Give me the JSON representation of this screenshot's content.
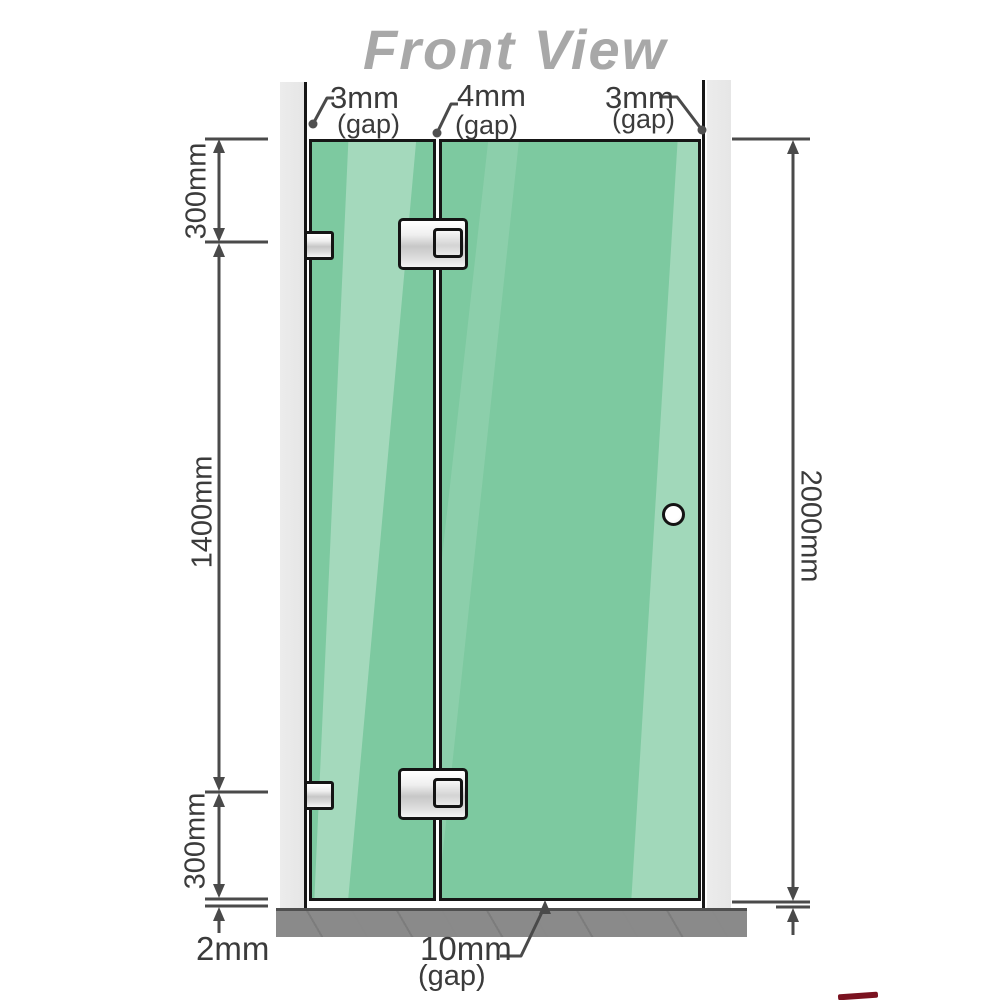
{
  "title": "Front View",
  "labels": {
    "gap_left": {
      "value": "3mm",
      "suffix": "(gap)"
    },
    "gap_middle": {
      "value": "4mm",
      "suffix": "(gap)"
    },
    "gap_right": {
      "value": "3mm",
      "suffix": "(gap)"
    },
    "dim_left_top": "300mm",
    "dim_left_middle": "1400mm",
    "dim_left_bottom": "300mm",
    "dim_right": "2000mm",
    "floor_gap": "2mm",
    "door_bottom_gap": {
      "value": "10mm",
      "suffix": "(gap)"
    }
  },
  "colors": {
    "glass": "#7dc9a0",
    "glass_highlight": "#b9e7cd",
    "wall": "#e9e9e9",
    "floor": "#8a8a8a",
    "outline": "#161616",
    "dimension_lines": "#4a4a4a",
    "title_text": "#a8a8a8",
    "label_text": "#3b3b3b",
    "watermark_red": "#7a1220"
  }
}
